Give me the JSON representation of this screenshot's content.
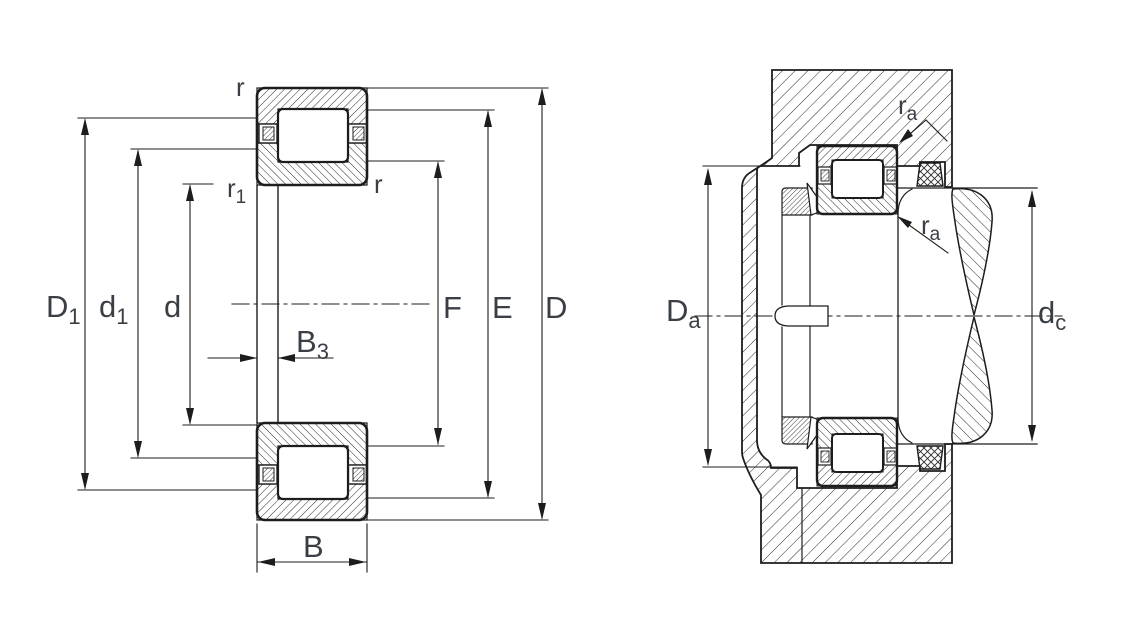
{
  "drawing": {
    "title": "cylindrical-roller-bearing-dimension-drawing",
    "background": "#ffffff",
    "line_color": "#1d1d1b",
    "text_color": "#3a3f45",
    "views": {
      "cross_section": {
        "name": "bearing-cross-section",
        "labels": {
          "r_top": {
            "base": "r",
            "sub": ""
          },
          "r1": {
            "base": "r",
            "sub": "1"
          },
          "r_inner": {
            "base": "r",
            "sub": ""
          },
          "D1": {
            "base": "D",
            "sub": "1"
          },
          "d1": {
            "base": "d",
            "sub": "1"
          },
          "d": {
            "base": "d",
            "sub": ""
          },
          "B3": {
            "base": "B",
            "sub": "3"
          },
          "B": {
            "base": "B",
            "sub": ""
          },
          "F": {
            "base": "F",
            "sub": ""
          },
          "E": {
            "base": "E",
            "sub": ""
          },
          "D": {
            "base": "D",
            "sub": ""
          }
        }
      },
      "mounting": {
        "name": "mounting-abutment-view",
        "labels": {
          "Da": {
            "base": "D",
            "sub": "a"
          },
          "dc": {
            "base": "d",
            "sub": "c"
          },
          "ra_housing": {
            "base": "r",
            "sub": "a"
          },
          "ra_shaft": {
            "base": "r",
            "sub": "a"
          }
        }
      }
    }
  }
}
